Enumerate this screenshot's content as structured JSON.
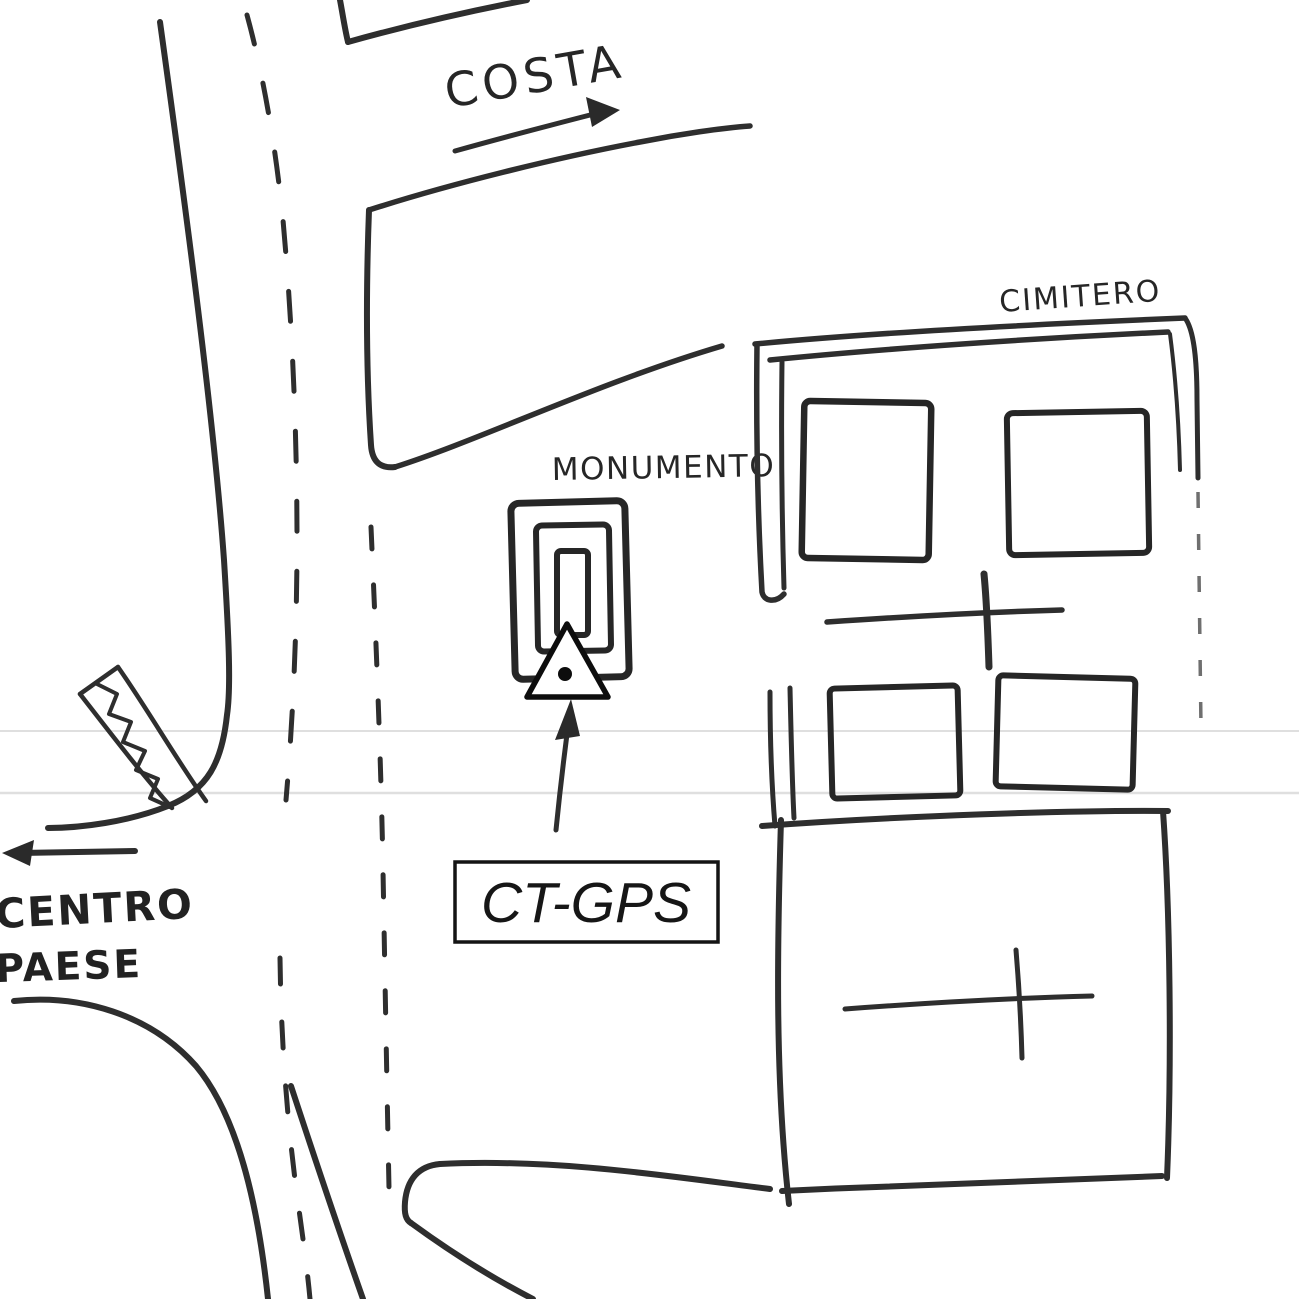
{
  "sketch": {
    "type": "hand-drawn-location-sketch",
    "colors": {
      "background": "#ffffff",
      "ink": "#2e2e2e",
      "marker_ink": "#0d0d0d",
      "faint_fold_line": "#dfdfdf"
    },
    "labels": {
      "costa": "COSTA",
      "cimitero": "CIMITERO",
      "monumento": "MONUMENTO",
      "centro": "CENTRO",
      "paese": "PAESE",
      "station_box": "CT-GPS"
    },
    "symbols": {
      "survey_marker": "triangle-with-center-dot",
      "stairs": "chevron-band",
      "cemetery_cross_count": 2,
      "arrows": [
        "costa-direction-arrow-northeast",
        "centro-paese-direction-arrow-west",
        "station-pointer-arrow-up"
      ],
      "road_markings": "dashed-center-lines"
    }
  }
}
